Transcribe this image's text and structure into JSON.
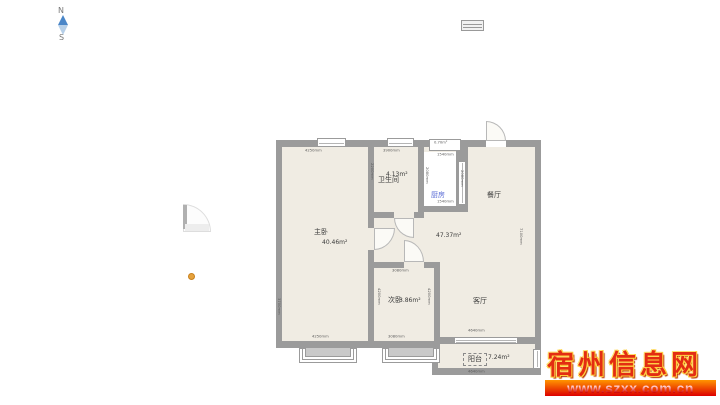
{
  "compass": {
    "north": "N",
    "south": "S"
  },
  "legend_icon": "window-symbol",
  "floorplan": {
    "hall_area": "47.37m²",
    "rooms": {
      "master_bedroom": {
        "name": "主卧",
        "area": "40.46m²"
      },
      "bathroom": {
        "name": "卫生间",
        "area": "4.13m²"
      },
      "kitchen": {
        "name": "厨房"
      },
      "dining": {
        "name": "餐厅"
      },
      "second_bedroom": {
        "name": "次卧",
        "area": "3.86m²"
      },
      "living": {
        "name": "客厅"
      },
      "balcony": {
        "name": "阳台",
        "area": "7.24m²"
      },
      "duct": {
        "area": "0.70m²"
      }
    },
    "dimensions": {
      "master_top": "4250mm",
      "bath_top": "3900mm",
      "bath_left": "2200mm",
      "kitchen_top": "1540mm",
      "kitchen_left": "2080mm",
      "kitchen_right": "2080mm",
      "kitchen_bottom": "1540mm",
      "right_side": "7100mm",
      "left_side": "3700mm",
      "second_top": "3080mm",
      "second_left": "4200mm",
      "second_right": "4200mm",
      "second_bottom": "3080mm",
      "master_bottom": "4250mm",
      "balcony_top": "4640mm",
      "balcony_bottom": "4640mm"
    },
    "colors": {
      "wall": "#9b9b9b",
      "floor": "#f0ece3",
      "kitchen_floor": "#ffffff",
      "kitchen_label": "#5b6dd6"
    }
  },
  "watermark": {
    "site_name": "宿州信息网",
    "site_url": "www.szxx.com.cn",
    "name_color": "#e32d12",
    "bar_gradient_top": "#ff9500",
    "bar_gradient_bottom": "#dd0000"
  }
}
